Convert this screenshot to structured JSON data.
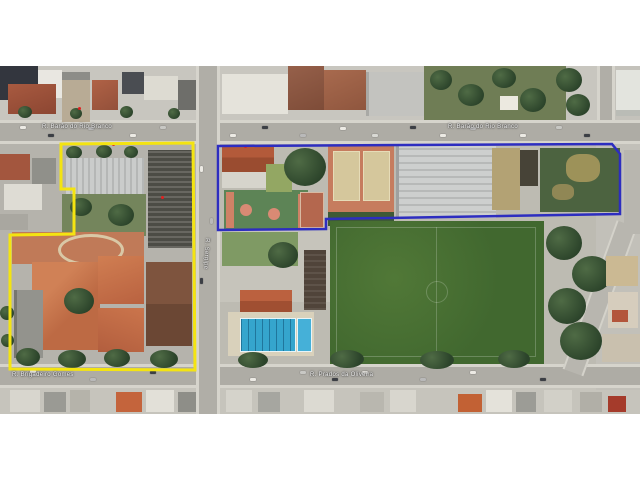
{
  "map": {
    "kind": "satellite-aerial-view",
    "street_labels": [
      {
        "id": "top_left",
        "text": "R. Barão do Rio Branco"
      },
      {
        "id": "top_right",
        "text": "R. Barão do Rio Branco"
      },
      {
        "id": "vertical_west",
        "text": "R. Sergipe"
      },
      {
        "id": "bottom_left",
        "text": "R. Brigadeiro Gomes"
      },
      {
        "id": "bottom_center",
        "text": "R. Prados da Oliveira"
      }
    ],
    "parcels": [
      {
        "name": "west-school-parcel",
        "outline_color": "#f4e411",
        "points": "61,78 193,77 195,304 10,303 10,169 74,168 74,123 61,123"
      },
      {
        "name": "east-school-parcel",
        "outline_color": "#2d2dc0",
        "points": "218,80 612,78 620,88 620,148 326,153 326,163 218,164"
      }
    ],
    "features": {
      "soccer_field": "large green pitch",
      "swimming_pool": "blue lap pool with lanes",
      "gymnasium": "large ribbed light-gray roof",
      "sports_courts": "green courts with salmon markings",
      "tennis_courts": "two clay-colored courts",
      "orange_roof_complex": "terracotta-roofed school buildings"
    }
  }
}
